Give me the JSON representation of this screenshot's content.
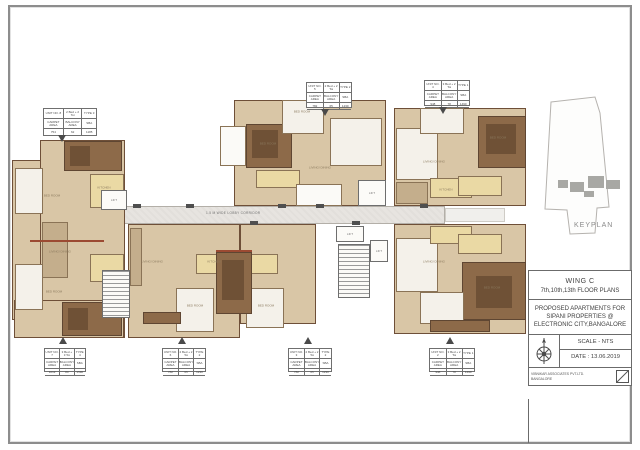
{
  "title_block": {
    "wing": "WING C",
    "floors": "7th,10th,13th FLOOR PLANS",
    "project": "PROPOSED APARTMENTS FOR SIPANI PROPERTIES @ ELECTRONIC CITY,BANGALORE",
    "scale": "SCALE - NTS",
    "date": "DATE : 13.06.2019",
    "firm": "VIBNIKAR ASSOCIATES PVT.LTD.",
    "firm_city": "BANGALORE",
    "compass_icon": "compass-rose-icon",
    "slash_icon": "diagonal-slash-box-icon"
  },
  "keyplan": {
    "label": "KEYPLAN"
  },
  "corridor": {
    "label": "1.5 M WIDE LOBBY CORRIDOR",
    "x": 206,
    "y": 211
  },
  "unit_tables": [
    {
      "x": 43,
      "y": 108,
      "w": 52,
      "h": 26,
      "arrow": "down",
      "arrow_x": 58,
      "arrow_y": 135,
      "header": [
        "UNIT NO. 8",
        "2 Bed + 2 Toi",
        "TYPE 3"
      ],
      "sub": [
        "CARPET AREA",
        "BALCONY AREA",
        "SBA"
      ],
      "values": [
        "754",
        "62",
        "1185"
      ]
    },
    {
      "x": 306,
      "y": 82,
      "w": 44,
      "h": 24,
      "arrow": "down",
      "arrow_x": 321,
      "arrow_y": 109,
      "header": [
        "UNIT NO. 5",
        "2 Bed + 2 Toi",
        "TYPE 2"
      ],
      "sub": [
        "CARPET AREA",
        "BALCONY AREA",
        "SBA"
      ],
      "values": [
        "782",
        "65",
        "1230"
      ]
    },
    {
      "x": 424,
      "y": 80,
      "w": 44,
      "h": 24,
      "arrow": "down",
      "arrow_x": 439,
      "arrow_y": 107,
      "header": [
        "UNIT NO. 4",
        "3 Bed + 2 Toi",
        "TYPE 1"
      ],
      "sub": [
        "CARPET AREA",
        "BALCONY AREA",
        "SBA"
      ],
      "values": [
        "948",
        "78",
        "1490"
      ]
    },
    {
      "x": 44,
      "y": 348,
      "w": 40,
      "h": 22,
      "arrow": "up",
      "arrow_x": 59,
      "arrow_y": 337,
      "header": [
        "UNIT NO. 7",
        "3 Bed + 3 Toi",
        "TYPE 4"
      ],
      "sub": [
        "CARPET AREA",
        "BALCONY AREA",
        "SBA"
      ],
      "values": [
        "1012",
        "84",
        "1590"
      ]
    },
    {
      "x": 162,
      "y": 348,
      "w": 42,
      "h": 22,
      "arrow": "up",
      "arrow_x": 178,
      "arrow_y": 337,
      "header": [
        "UNIT NO. 6",
        "2 Bed + 2 Toi",
        "TYPE 2"
      ],
      "sub": [
        "CARPET AREA",
        "BALCONY AREA",
        "SBA"
      ],
      "values": [
        "782",
        "65",
        "1230"
      ]
    },
    {
      "x": 288,
      "y": 348,
      "w": 42,
      "h": 22,
      "arrow": "up",
      "arrow_x": 304,
      "arrow_y": 337,
      "header": [
        "UNIT NO. 3",
        "2 Bed + 2 Toi",
        "TYPE 2"
      ],
      "sub": [
        "CARPET AREA",
        "BALCONY AREA",
        "SBA"
      ],
      "values": [
        "782",
        "65",
        "1230"
      ]
    },
    {
      "x": 429,
      "y": 348,
      "w": 44,
      "h": 22,
      "arrow": "up",
      "arrow_x": 446,
      "arrow_y": 337,
      "header": [
        "UNIT NO. 2",
        "3 Bed + 2 Toi",
        "TYPE 1"
      ],
      "sub": [
        "CARPET AREA",
        "BALCONY AREA",
        "SBA"
      ],
      "values": [
        "948",
        "78",
        "1490"
      ]
    }
  ],
  "rooms": [
    {
      "x": 52,
      "y": 196,
      "label": "BED ROOM"
    },
    {
      "x": 104,
      "y": 188,
      "label": "KITCHEN"
    },
    {
      "x": 60,
      "y": 252,
      "label": "LIVING/ DINING"
    },
    {
      "x": 54,
      "y": 292,
      "label": "BED ROOM"
    },
    {
      "x": 152,
      "y": 262,
      "label": "LIVING/ DINING"
    },
    {
      "x": 195,
      "y": 306,
      "label": "BED ROOM"
    },
    {
      "x": 214,
      "y": 262,
      "label": "KITCHEN"
    },
    {
      "x": 268,
      "y": 144,
      "label": "BED ROOM"
    },
    {
      "x": 320,
      "y": 168,
      "label": "LIVING/ DINING"
    },
    {
      "x": 302,
      "y": 112,
      "label": "BED ROOM"
    },
    {
      "x": 434,
      "y": 162,
      "label": "LIVING/ DINING"
    },
    {
      "x": 498,
      "y": 138,
      "label": "BED ROOM"
    },
    {
      "x": 446,
      "y": 190,
      "label": "KITCHEN"
    },
    {
      "x": 434,
      "y": 262,
      "label": "LIVING/ DINING"
    },
    {
      "x": 492,
      "y": 288,
      "label": "BED ROOM"
    },
    {
      "x": 266,
      "y": 306,
      "label": "BED ROOM"
    }
  ],
  "lifts": [
    {
      "x": 101,
      "y": 190,
      "w": 26,
      "h": 20,
      "label": "LIFT"
    },
    {
      "x": 358,
      "y": 180,
      "w": 28,
      "h": 26,
      "label": "LIFT"
    },
    {
      "x": 336,
      "y": 226,
      "w": 28,
      "h": 16,
      "label": "LIFT"
    },
    {
      "x": 370,
      "y": 240,
      "w": 18,
      "h": 22,
      "label": "LIFT"
    }
  ],
  "plan_shapes": [
    {
      "x": 95,
      "y": 206,
      "w": 350,
      "h": 18,
      "cls": "corridor"
    },
    {
      "x": 445,
      "y": 208,
      "w": 60,
      "h": 14,
      "cls": "corridor-light"
    },
    {
      "x": 12,
      "y": 160,
      "w": 50,
      "h": 160,
      "cls": "base"
    },
    {
      "x": 40,
      "y": 140,
      "w": 85,
      "h": 198,
      "cls": "base"
    },
    {
      "x": 14,
      "y": 300,
      "w": 110,
      "h": 38,
      "cls": "base"
    },
    {
      "x": 64,
      "y": 141,
      "w": 58,
      "h": 30,
      "cls": "room-brown"
    },
    {
      "x": 70,
      "y": 146,
      "w": 20,
      "h": 20,
      "cls": "room-dark"
    },
    {
      "x": 62,
      "y": 302,
      "w": 60,
      "h": 34,
      "cls": "room-brown"
    },
    {
      "x": 68,
      "y": 308,
      "w": 20,
      "h": 22,
      "cls": "room-dark"
    },
    {
      "x": 15,
      "y": 168,
      "w": 28,
      "h": 46,
      "cls": "room-white"
    },
    {
      "x": 15,
      "y": 264,
      "w": 28,
      "h": 46,
      "cls": "room-white"
    },
    {
      "x": 90,
      "y": 174,
      "w": 34,
      "h": 34,
      "cls": "room-cream"
    },
    {
      "x": 90,
      "y": 254,
      "w": 34,
      "h": 28,
      "cls": "room-cream"
    },
    {
      "x": 42,
      "y": 222,
      "w": 26,
      "h": 56,
      "cls": "room-taupe"
    },
    {
      "x": 30,
      "y": 240,
      "w": 74,
      "h": 2,
      "cls": "wall-red"
    },
    {
      "x": 128,
      "y": 224,
      "w": 112,
      "h": 114,
      "cls": "base"
    },
    {
      "x": 240,
      "y": 224,
      "w": 76,
      "h": 100,
      "cls": "base"
    },
    {
      "x": 176,
      "y": 288,
      "w": 38,
      "h": 44,
      "cls": "room-white"
    },
    {
      "x": 246,
      "y": 288,
      "w": 38,
      "h": 40,
      "cls": "room-white"
    },
    {
      "x": 196,
      "y": 254,
      "w": 42,
      "h": 20,
      "cls": "room-cream"
    },
    {
      "x": 240,
      "y": 254,
      "w": 38,
      "h": 20,
      "cls": "room-cream"
    },
    {
      "x": 143,
      "y": 312,
      "w": 38,
      "h": 12,
      "cls": "room-brown"
    },
    {
      "x": 130,
      "y": 228,
      "w": 12,
      "h": 58,
      "cls": "room-taupe"
    },
    {
      "x": 216,
      "y": 252,
      "w": 36,
      "h": 62,
      "cls": "room-brown"
    },
    {
      "x": 222,
      "y": 260,
      "w": 22,
      "h": 40,
      "cls": "room-dark"
    },
    {
      "x": 216,
      "y": 250,
      "w": 36,
      "h": 2,
      "cls": "wall-red"
    },
    {
      "x": 234,
      "y": 100,
      "w": 152,
      "h": 106,
      "cls": "base"
    },
    {
      "x": 246,
      "y": 124,
      "w": 46,
      "h": 44,
      "cls": "room-brown"
    },
    {
      "x": 252,
      "y": 130,
      "w": 26,
      "h": 28,
      "cls": "room-dark"
    },
    {
      "x": 282,
      "y": 100,
      "w": 42,
      "h": 34,
      "cls": "room-white"
    },
    {
      "x": 256,
      "y": 170,
      "w": 44,
      "h": 18,
      "cls": "room-cream"
    },
    {
      "x": 330,
      "y": 118,
      "w": 52,
      "h": 48,
      "cls": "room-white"
    },
    {
      "x": 220,
      "y": 126,
      "w": 26,
      "h": 40,
      "cls": "box-white"
    },
    {
      "x": 296,
      "y": 184,
      "w": 46,
      "h": 22,
      "cls": "box-white"
    },
    {
      "x": 338,
      "y": 244,
      "w": 32,
      "h": 54,
      "cls": "stair"
    },
    {
      "x": 102,
      "y": 270,
      "w": 28,
      "h": 48,
      "cls": "stair"
    },
    {
      "x": 394,
      "y": 108,
      "w": 132,
      "h": 98,
      "cls": "base"
    },
    {
      "x": 478,
      "y": 116,
      "w": 48,
      "h": 52,
      "cls": "room-brown"
    },
    {
      "x": 486,
      "y": 124,
      "w": 30,
      "h": 30,
      "cls": "room-dark"
    },
    {
      "x": 396,
      "y": 128,
      "w": 42,
      "h": 52,
      "cls": "room-white"
    },
    {
      "x": 420,
      "y": 108,
      "w": 44,
      "h": 26,
      "cls": "room-white"
    },
    {
      "x": 430,
      "y": 178,
      "w": 42,
      "h": 20,
      "cls": "room-cream"
    },
    {
      "x": 458,
      "y": 176,
      "w": 44,
      "h": 20,
      "cls": "room-cream"
    },
    {
      "x": 396,
      "y": 182,
      "w": 32,
      "h": 22,
      "cls": "room-taupe"
    },
    {
      "x": 394,
      "y": 224,
      "w": 132,
      "h": 110,
      "cls": "base"
    },
    {
      "x": 462,
      "y": 262,
      "w": 64,
      "h": 58,
      "cls": "room-brown"
    },
    {
      "x": 476,
      "y": 276,
      "w": 36,
      "h": 32,
      "cls": "room-dark"
    },
    {
      "x": 396,
      "y": 238,
      "w": 42,
      "h": 54,
      "cls": "room-white"
    },
    {
      "x": 430,
      "y": 226,
      "w": 42,
      "h": 18,
      "cls": "room-cream"
    },
    {
      "x": 458,
      "y": 234,
      "w": 44,
      "h": 20,
      "cls": "room-cream"
    },
    {
      "x": 420,
      "y": 292,
      "w": 44,
      "h": 32,
      "cls": "room-white"
    },
    {
      "x": 430,
      "y": 320,
      "w": 60,
      "h": 12,
      "cls": "room-brown"
    },
    {
      "x": 133,
      "y": 204,
      "w": 8,
      "h": 4,
      "cls": "tick"
    },
    {
      "x": 186,
      "y": 204,
      "w": 8,
      "h": 4,
      "cls": "tick"
    },
    {
      "x": 278,
      "y": 204,
      "w": 8,
      "h": 4,
      "cls": "tick"
    },
    {
      "x": 316,
      "y": 204,
      "w": 8,
      "h": 4,
      "cls": "tick"
    },
    {
      "x": 420,
      "y": 204,
      "w": 8,
      "h": 4,
      "cls": "tick"
    },
    {
      "x": 250,
      "y": 221,
      "w": 8,
      "h": 4,
      "cls": "tick"
    },
    {
      "x": 352,
      "y": 221,
      "w": 8,
      "h": 4,
      "cls": "tick"
    }
  ]
}
